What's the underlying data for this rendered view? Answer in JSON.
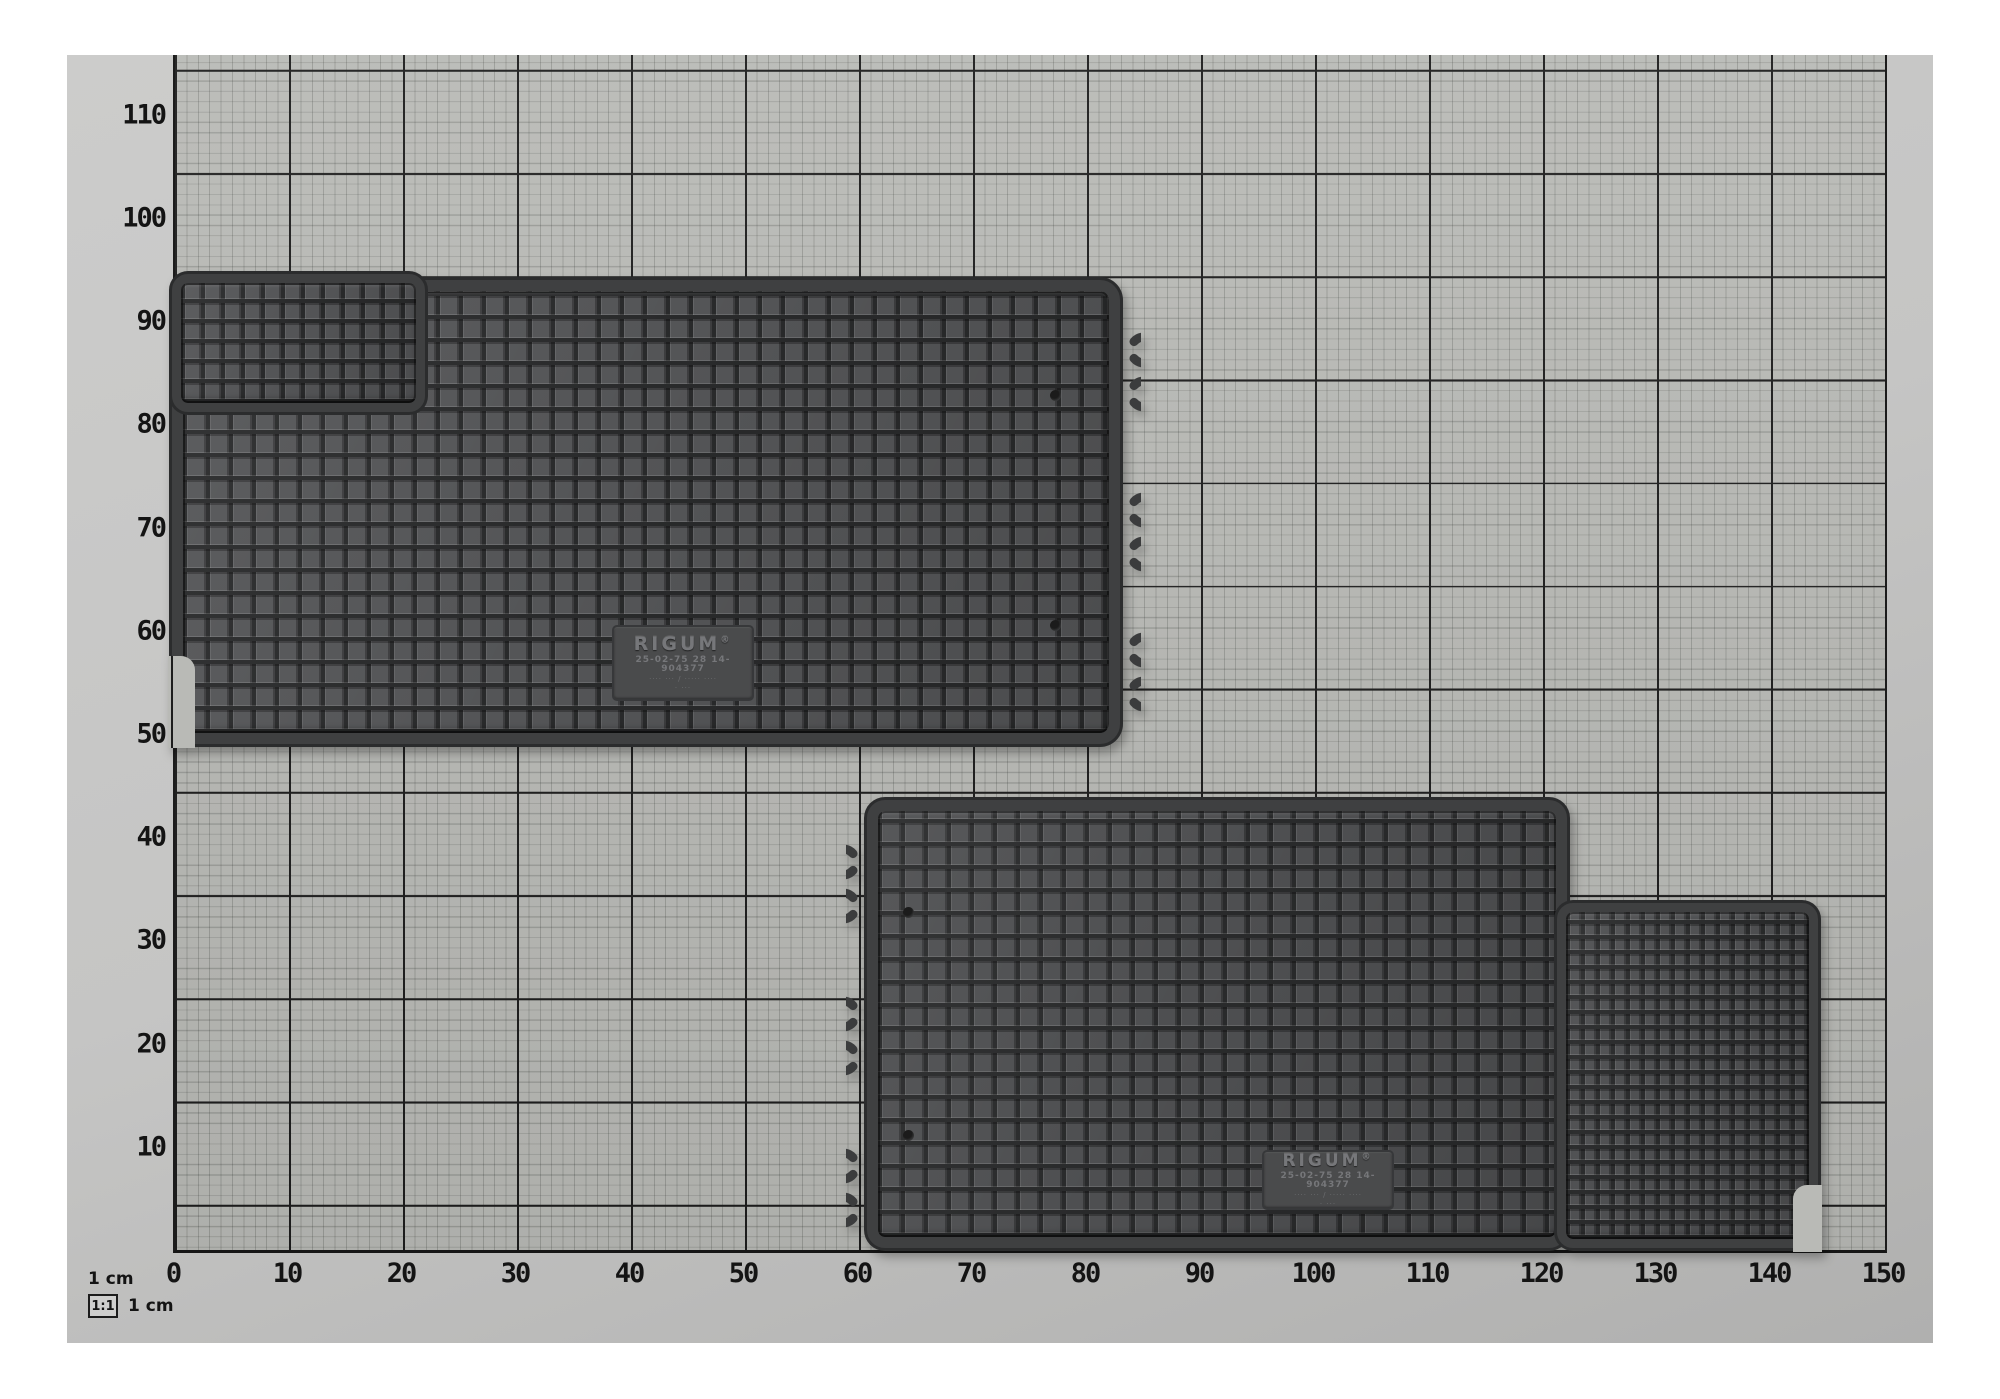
{
  "photo": {
    "axes": {
      "x_ticks": [
        "0",
        "10",
        "20",
        "30",
        "40",
        "50",
        "60",
        "70",
        "80",
        "90",
        "100",
        "110",
        "120",
        "130",
        "140",
        "150"
      ],
      "y_ticks": [
        "110",
        "100",
        "90",
        "80",
        "70",
        "60",
        "50",
        "40",
        "30",
        "20",
        "10"
      ],
      "unit": "cm"
    },
    "legend": {
      "ruler_label": "1 cm",
      "scale_ratio": "1:1",
      "scale_unit": "1 cm"
    },
    "mats": [
      {
        "label": {
          "brand": "RIGUM",
          "reg": "®",
          "code": "25-02-75 28 14- 904377",
          "line3": "···· ··· / ····· ····",
          "line4": "· ···"
        }
      },
      {
        "label": {
          "brand": "RIGUM",
          "reg": "®",
          "code": "25-02-75 28 14- 904377",
          "line3": "···· ··· / ····· ····",
          "line4": "· ···"
        }
      }
    ],
    "colors": {
      "mat_cell": "#545557",
      "mat_groove": "#292a2b",
      "mat_band": "#3f4041",
      "paper_bg": "#b9bab6",
      "bold_line": "#1c1c1c",
      "photo_margin": "#c5c5c4"
    }
  }
}
